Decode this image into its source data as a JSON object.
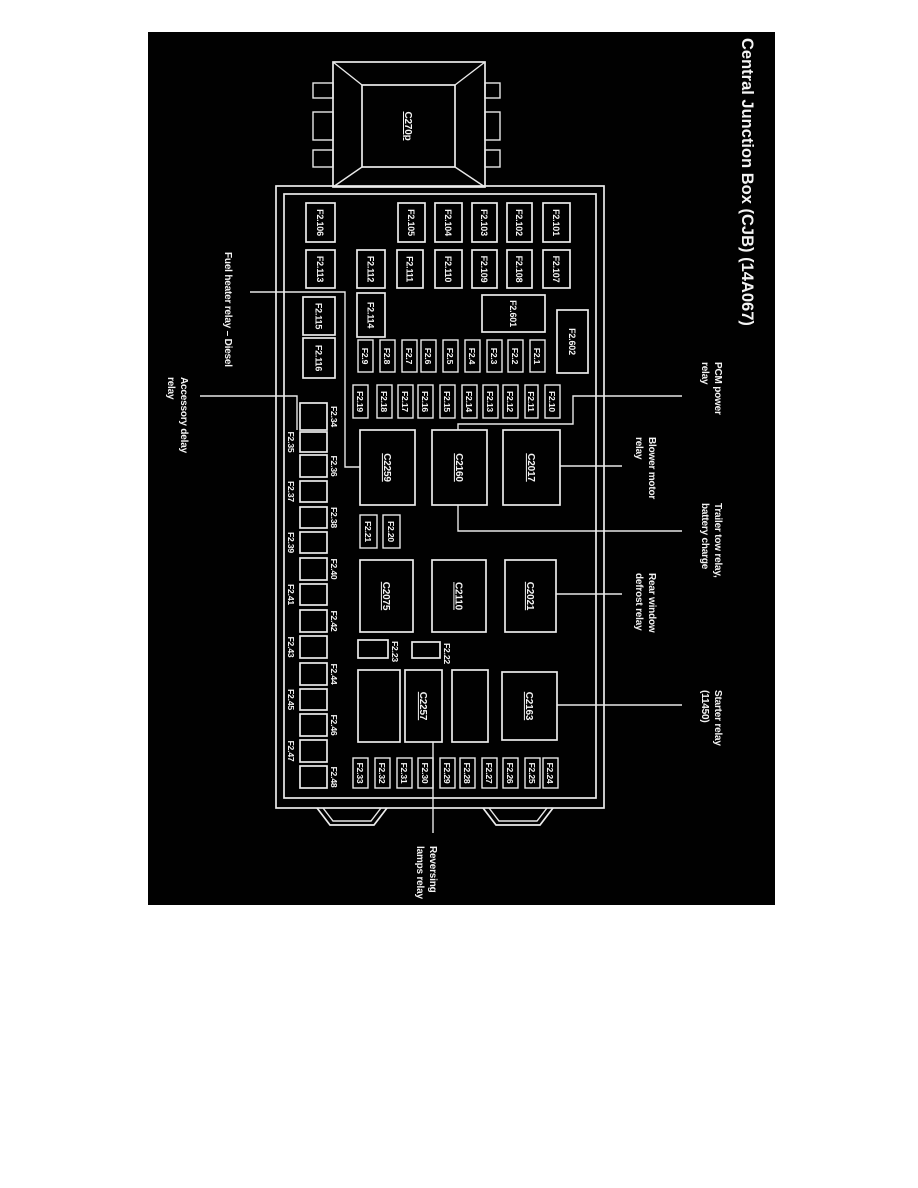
{
  "title": "Central Junction Box (CJB) (14A067)",
  "connector_label": "C270p",
  "fuses": [
    "F2.101",
    "F2.102",
    "F2.103",
    "F2.104",
    "F2.105",
    "F2.106",
    "F2.107",
    "F2.108",
    "F2.109",
    "F2.110",
    "F2.111",
    "F2.112",
    "F2.113",
    "F2.601",
    "F2.114",
    "F2.115",
    "F2.602",
    "F2.116",
    "F2.1",
    "F2.2",
    "F2.3",
    "F2.4",
    "F2.5",
    "F2.6",
    "F2.7",
    "F2.8",
    "F2.9",
    "F2.10",
    "F2.11",
    "F2.12",
    "F2.13",
    "F2.14",
    "F2.15",
    "F2.16",
    "F2.17",
    "F2.18",
    "F2.19",
    "F2.20",
    "F2.21",
    "F2.22",
    "F2.23",
    "F2.24",
    "F2.25",
    "F2.26",
    "F2.27",
    "F2.28",
    "F2.29",
    "F2.30",
    "F2.31",
    "F2.32",
    "F2.33",
    "F2.34",
    "F2.35",
    "F2.36",
    "F2.37",
    "F2.38",
    "F2.39",
    "F2.40",
    "F2.41",
    "F2.42",
    "F2.43",
    "F2.44",
    "F2.45",
    "F2.46",
    "F2.47",
    "F2.48"
  ],
  "relays": [
    "C2017",
    "C2160",
    "C2259",
    "C2021",
    "C2110",
    "C2075",
    "C2163",
    "C2257"
  ],
  "callouts": [
    {
      "name": "pcm-power-relay",
      "lines": [
        "PCM power",
        "relay"
      ]
    },
    {
      "name": "blower-motor-relay",
      "lines": [
        "Blower motor",
        "relay"
      ]
    },
    {
      "name": "trailer-tow-relay",
      "lines": [
        "Trailer tow relay,",
        "battery charge"
      ]
    },
    {
      "name": "rear-window-defrost-relay",
      "lines": [
        "Rear window",
        "defrost relay"
      ]
    },
    {
      "name": "starter-relay",
      "lines": [
        "Starter relay",
        "(11450)"
      ]
    },
    {
      "name": "fuel-heater-relay",
      "lines": [
        "Fuel heater relay – Diesel"
      ]
    },
    {
      "name": "accessory-delay-relay",
      "lines": [
        "Accessory delay",
        "relay"
      ]
    },
    {
      "name": "reversing-lamps-relay",
      "lines": [
        "Reversing",
        "lamps relay"
      ]
    }
  ],
  "colors": {
    "background": "#000000",
    "line": "#ececec",
    "text": "#f4f4f4",
    "page": "#ffffff"
  }
}
